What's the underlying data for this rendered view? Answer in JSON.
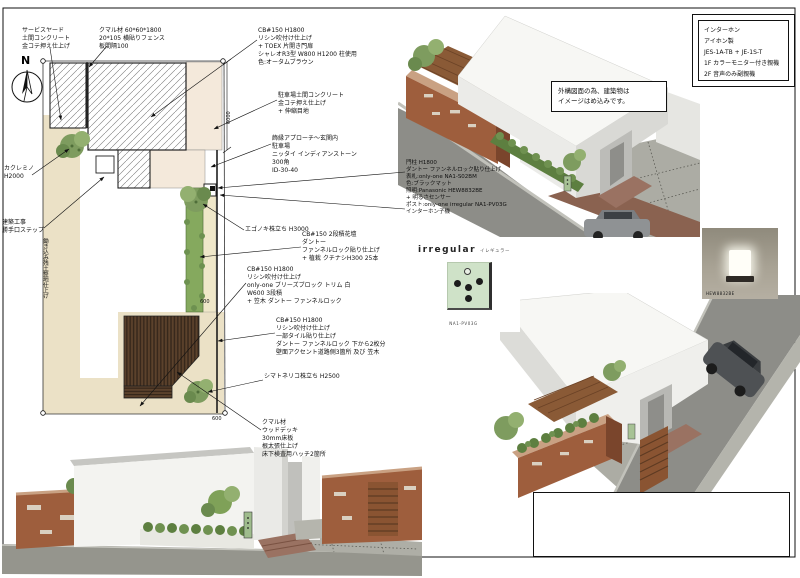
{
  "north_label": "N",
  "plan": {
    "dim_right": "6000",
    "dim_top": "600",
    "dim_bottom": "600",
    "labels": {
      "service_yard": [
        "サービスヤード",
        "土間コンクリート",
        "金コテ押え仕上げ"
      ],
      "kumaru_fence": [
        "クマル材 60*60*1800",
        "20*105 横貼りフェンス",
        "板間隔100"
      ],
      "gate_block": [
        "CB#150 H1800",
        "リシン吹付け仕上げ",
        "+ TOEX 片開き門扉",
        "シャレオR3型 W800 H1200 柱使用",
        "色:オータムブラウン"
      ],
      "parking": [
        "駐車場土間コンクリート",
        "金コテ押え仕上げ",
        "+ 伸縮目地"
      ],
      "approach": [
        "飾縁アプローチ～玄関内",
        "駐車場",
        "ニッタイ インディアンストーン",
        "300角",
        "ID-30-40"
      ],
      "gate_post": [
        "門柱 H1800",
        "ダントー ファンネルロック貼り仕上げ",
        "表札:only-one NA1-S02BM",
        "色:ブラックマット",
        "照明:Panasonic HEW8832BE",
        "+ 明るさセンサー",
        "ポスト:only-one irregular NA1-PV03G",
        "インターホン子機"
      ],
      "egonoki": [
        "エゴノキ株立ち H3000"
      ],
      "flower_bed": [
        "CB#150 2段積花壇",
        "ダントー",
        "ファンネルロック貼り仕上げ",
        "+ 植栽 クチナシH300 25本"
      ],
      "breeze_wall": [
        "CB#150 H1800",
        "リシン吹付け仕上げ",
        "only-one ブリーズブロック トリム 白",
        "W600 3段積",
        "+ 笠木 ダントー ファンネルロック"
      ],
      "tile_wall": [
        "CB#150 H1800",
        "リシン吹付け仕上げ",
        "一部タイル貼り仕上げ",
        "ダントー ファンネルロック 下から2枚分",
        "壁面アクセント道路側3箇所 及び 笠木"
      ],
      "shimatoneriko": [
        "シマトネリコ株立ち H2500"
      ],
      "wood_deck": [
        "クマル材",
        "ウッドデッキ",
        "30mm床板",
        "根太張仕上げ",
        "床下検査用ハッチ2箇所"
      ],
      "kakuremino": [
        "カクレミノ",
        "H2000"
      ],
      "kitchen_step": [
        "建築工事",
        "勝手口ステップ"
      ],
      "ground_soil": "鋤き込み残土整地仕上げ"
    }
  },
  "interphone_box": [
    "インターホン",
    "アイホン製",
    "JES-1A-TB + JE-1S-T",
    "1F カラーモニター付き親機",
    "2F 音声のみ副親機"
  ],
  "render_note": [
    "外構図面の為、建築物は",
    "イメージはめ込みです。"
  ],
  "products": {
    "irregular": {
      "title": "irregular",
      "kana": "イレギュラー",
      "caption": "NA1-PV03G"
    },
    "gate_light": {
      "caption": "HEW8832BE"
    }
  },
  "colors": {
    "ground_beige": "#ebe1c6",
    "concrete_pink": "#f4e9db",
    "hedge_green": "#85a95e",
    "deck_brown": "#5c422c",
    "tile_wall_brown": "#9e5e3d",
    "road_gray": "#8d8d88",
    "irregular_green": "#cfe2c8"
  }
}
